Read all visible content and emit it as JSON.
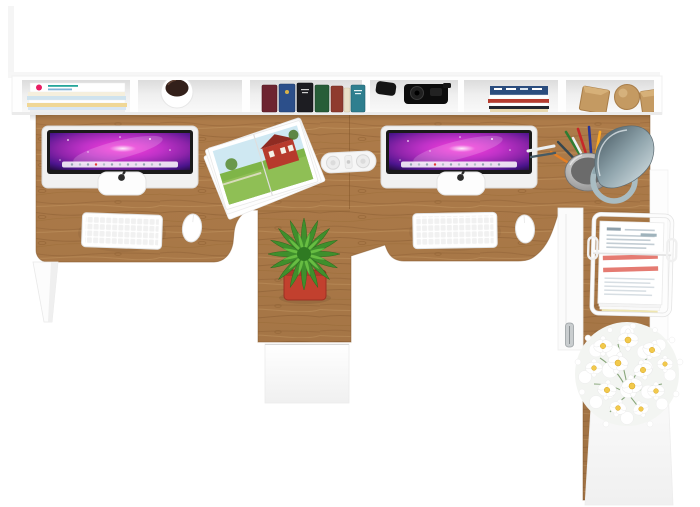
{
  "scene": {
    "title": "Two-person office desk with hutch - top view product render",
    "type": "furniture-product-render",
    "view": "top-down",
    "background": "#ffffff"
  },
  "palette": {
    "desk_wood": "#ad7b49",
    "wood_grain": "#8a5c30",
    "wood_grain_light": "#c79a63",
    "furniture_white": "#fbfbfb",
    "screen_pink": "#e93ad6",
    "screen_deep_purple": "#1c0a2e",
    "plant_green_dark": "#3f8f2c",
    "plant_green_light": "#67bd42",
    "pot_red": "#c2402e",
    "lamp_metal": "#a9bcc2",
    "flower_center_yellow": "#f2c94c",
    "paper_highlight_red": "#e57b72",
    "coffee_brown": "#33201a",
    "barn_red": "#b73a2c"
  },
  "shelf": {
    "description": "White wall hutch with six open compartments",
    "compartments": [
      {
        "id": "A",
        "contents": "stack of flat magazines"
      },
      {
        "id": "B",
        "contents": "white mug with coffee"
      },
      {
        "id": "C",
        "contents": "row of standing books",
        "books": [
          {
            "color": "#6d2430"
          },
          {
            "color": "#2c4f8a"
          },
          {
            "color": "#1d1d22"
          },
          {
            "color": "#275d38"
          },
          {
            "color": "#8f3b2e"
          },
          {
            "color": "#e8e0c8"
          },
          {
            "color": "#2f7f8f"
          }
        ]
      },
      {
        "id": "D",
        "contents": "black camera and accessories"
      },
      {
        "id": "E",
        "contents": "stack of colorful magazines"
      },
      {
        "id": "F",
        "contents": "wooden decor cubes and sphere"
      }
    ]
  },
  "desk": {
    "material": "oak wood top with white frame and legs",
    "workstations": [
      {
        "position": "left",
        "monitor": "iMac with purple galaxy wallpaper",
        "keyboard": "white wireless keyboard",
        "mouse": "white mouse"
      },
      {
        "position": "right",
        "monitor": "iMac with purple galaxy wallpaper",
        "keyboard": "white wireless keyboard",
        "mouse": "white mouse"
      }
    ],
    "pedestal": "center column with white drawer front and potted plant",
    "return": "right return with wire document tray and white daisy bouquet"
  },
  "accessories": [
    "open magazine with red farmhouse photo",
    "white power strip on desk seam",
    "green potted plant in red pot",
    "metal mesh pencil cup with colored pens",
    "gray metal desk lamp with round ring base",
    "white wire document tray with stacked papers",
    "bouquet of white daisies on white cabinet"
  ]
}
